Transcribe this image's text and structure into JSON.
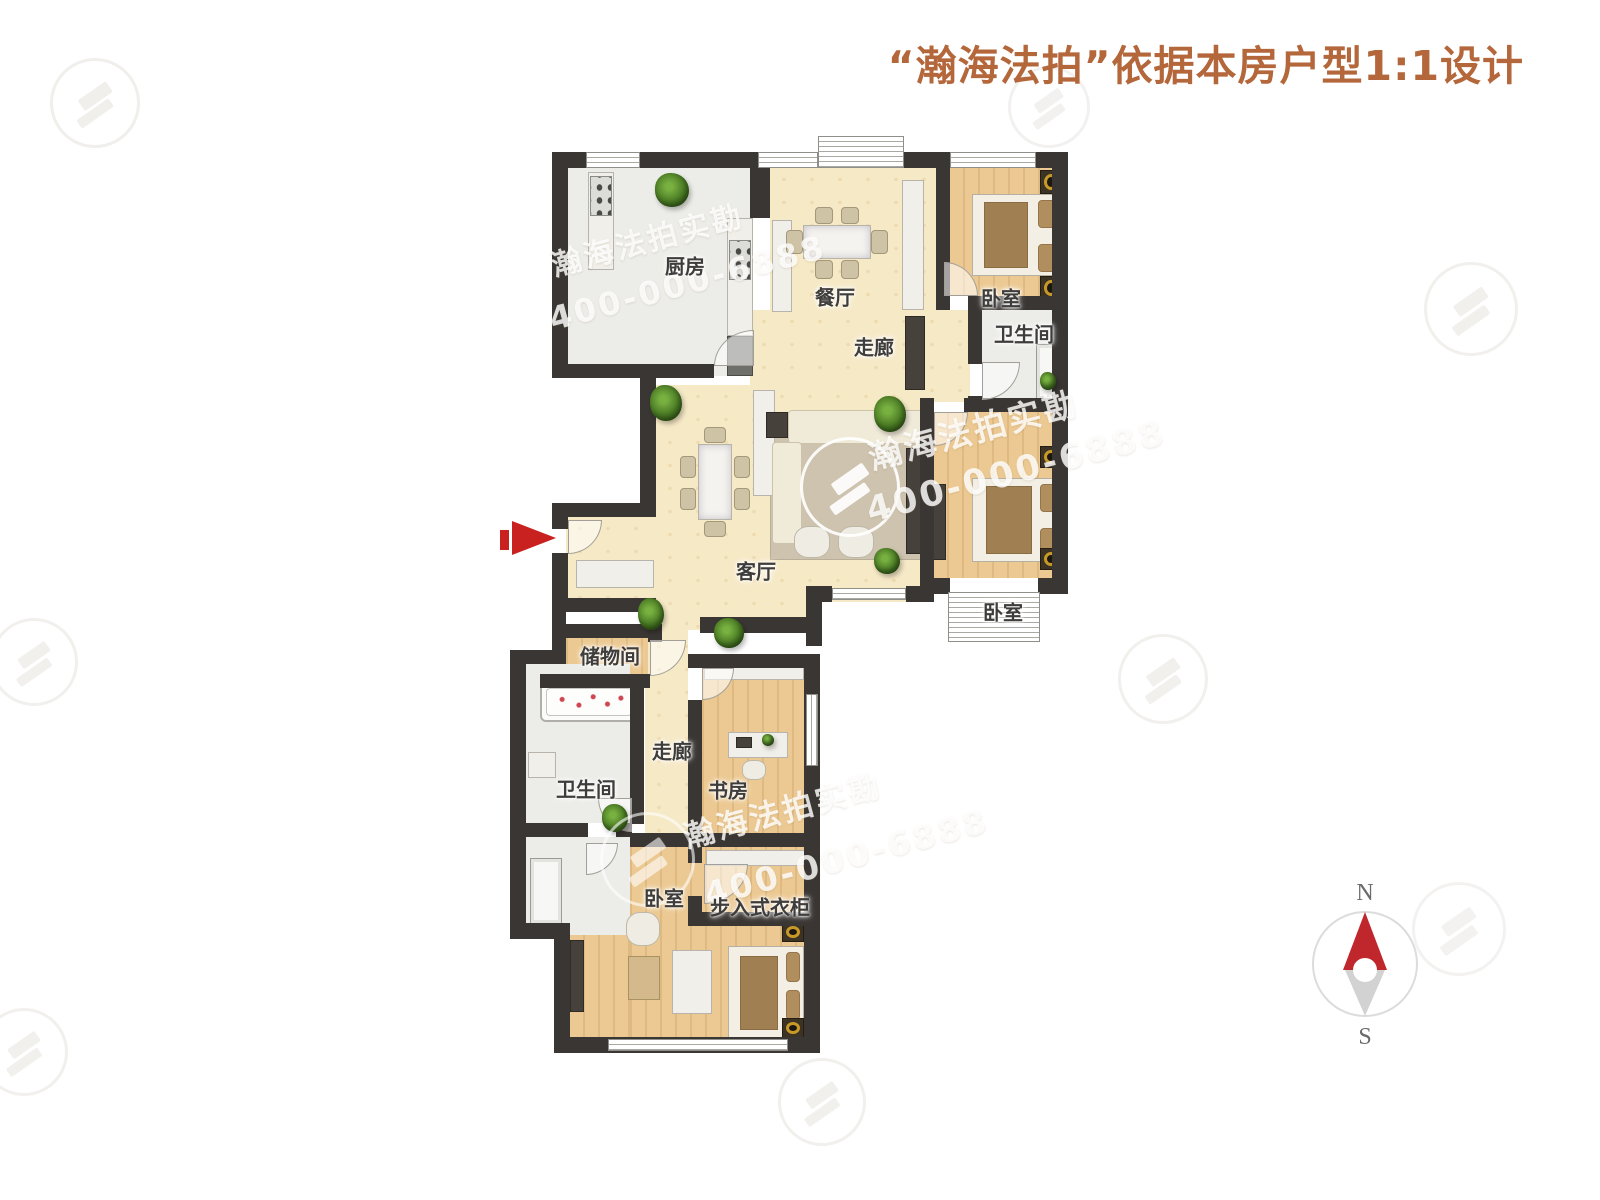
{
  "title": "“瀚海法拍”依据本房户型1:1设计",
  "rooms": {
    "kitchen": "厨房",
    "dining": "餐厅",
    "corridor_upper": "走廊",
    "bedroom_ne": "卧室",
    "bathroom_ne": "卫生间",
    "living": "客厅",
    "bedroom_e": "卧室",
    "storage": "储物间",
    "bathroom_w": "卫生间",
    "corridor_lower": "走廊",
    "study": "书房",
    "bedroom_s": "卧室",
    "closet": "步入式衣柜"
  },
  "watermark": {
    "brand": "瀚海法拍实勘",
    "phone": "400-000-6888"
  },
  "compass": {
    "north": "N",
    "south": "S"
  },
  "colors": {
    "title": "#b4673a",
    "wall": "#3a3633",
    "floor_wood": "#ecc992",
    "floor_cream": "#f6e9c6",
    "floor_gray": "#ececE8",
    "arrow_red": "#c92020",
    "compass_red": "#c0272d"
  }
}
